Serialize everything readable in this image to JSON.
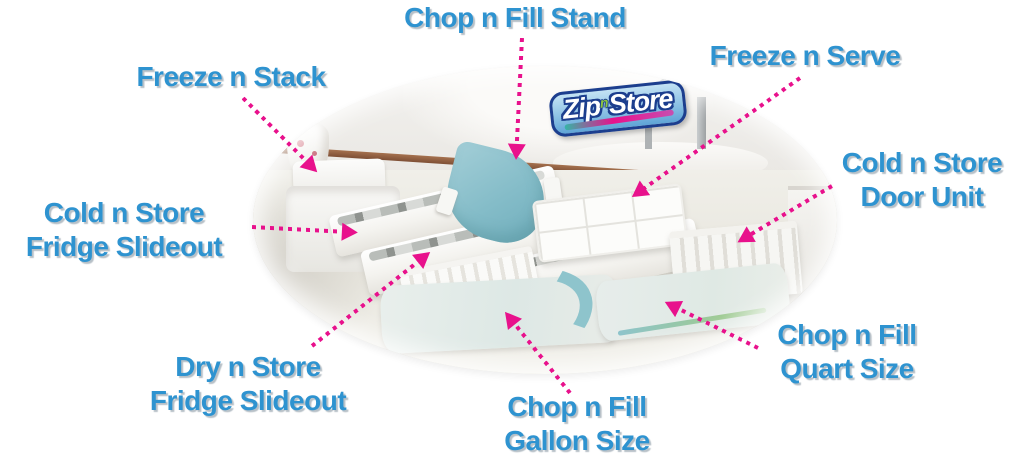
{
  "logo": {
    "zip": "Zip",
    "n": "n",
    "store": "Store"
  },
  "colors": {
    "label_blue": "#2e93d0",
    "arrow_pink": "#e8118c",
    "stand_teal": "#84bcc8",
    "counter_trim_brown": "#8a5a3c",
    "logo_outline_blue": "#1c3e8e",
    "logo_n_green": "#8dc63f"
  },
  "labels": [
    {
      "id": "chop-n-fill-stand",
      "lines": [
        "Chop n Fill Stand"
      ]
    },
    {
      "id": "freeze-n-stack",
      "lines": [
        "Freeze n Stack"
      ]
    },
    {
      "id": "freeze-n-serve",
      "lines": [
        "Freeze n Serve"
      ]
    },
    {
      "id": "cold-n-store-door-unit",
      "lines": [
        "Cold n Store",
        "Door Unit"
      ]
    },
    {
      "id": "cold-n-store-fridge-slideout",
      "lines": [
        "Cold n Store",
        "Fridge Slideout"
      ]
    },
    {
      "id": "dry-n-store-fridge-slideout",
      "lines": [
        "Dry n Store",
        "Fridge Slideout"
      ]
    },
    {
      "id": "chop-n-fill-gallon-size",
      "lines": [
        "Chop n Fill",
        "Gallon Size"
      ]
    },
    {
      "id": "chop-n-fill-quart-size",
      "lines": [
        "Chop n Fill",
        "Quart Size"
      ]
    }
  ]
}
